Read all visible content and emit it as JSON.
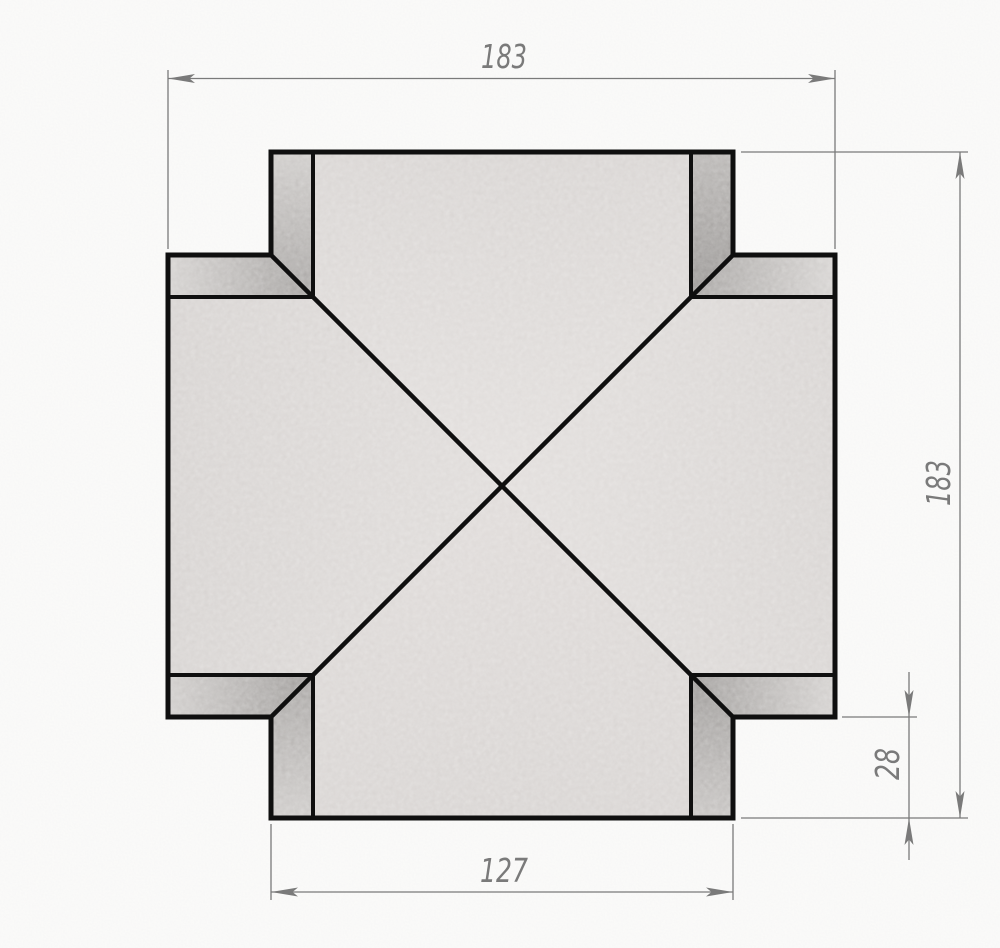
{
  "drawing": {
    "kind": "technical-dimension-drawing",
    "part": "four-way-cross-fitting",
    "view": "front"
  },
  "dimensions": {
    "overall_width": {
      "value": "183",
      "orientation": "horizontal",
      "position": "top"
    },
    "overall_height": {
      "value": "183",
      "orientation": "vertical",
      "position": "right"
    },
    "port_width": {
      "value": "127",
      "orientation": "horizontal",
      "position": "bottom"
    },
    "arm_protrusion": {
      "value": "28",
      "orientation": "vertical",
      "position": "right-lower"
    }
  },
  "colors": {
    "background": "#fcfcfb",
    "edge_lines": "#0f0f0f",
    "dimension": "#7a7a7a",
    "surface_light": "#dcd8d6",
    "surface_mid": "#c7c4c2",
    "surface_shadow": "#8f8c8a"
  }
}
